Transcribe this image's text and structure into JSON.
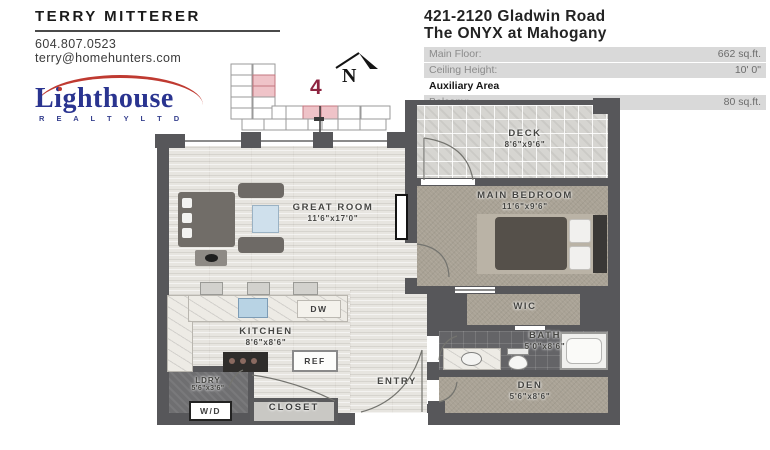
{
  "agent": {
    "name": "TERRY MITTERER",
    "phone": "604.807.0523",
    "email": "terry@homehunters.com"
  },
  "brokerage": {
    "name": "Lighthouse",
    "subtitle": "R E A L T Y   L T D"
  },
  "listing": {
    "address_line": "421-2120 Gladwin Road",
    "building_line": "The ONYX at Mahogany"
  },
  "details": {
    "main_rows": [
      {
        "label": "Main Floor:",
        "value": "662 sq.ft."
      },
      {
        "label": "Ceiling Height:",
        "value": "10' 0\""
      }
    ],
    "aux_header": "Auxiliary Area",
    "aux_rows": [
      {
        "label": "Balcony:",
        "value": "80 sq.ft."
      }
    ]
  },
  "keyplan": {
    "unit_number": "4",
    "highlight_color": "#efc3c8"
  },
  "compass": {
    "label": "N"
  },
  "rooms": {
    "great_room": {
      "name": "GREAT ROOM",
      "dims": "11'6\"x17'0\""
    },
    "deck": {
      "name": "DECK",
      "dims": "8'6\"x9'6\""
    },
    "main_bedroom": {
      "name": "MAIN BEDROOM",
      "dims": "11'6\"x9'6\""
    },
    "wic": {
      "name": "WIC"
    },
    "bath": {
      "name": "BATH",
      "dims": "5'0\"x8'6\""
    },
    "den": {
      "name": "DEN",
      "dims": "5'6\"x8'6\""
    },
    "kitchen": {
      "name": "KITCHEN",
      "dims": "8'6\"x8'6\""
    },
    "ldry": {
      "name": "LDRY",
      "dims": "5'6\"x3'6\""
    },
    "entry": {
      "name": "ENTRY"
    },
    "closet": {
      "name": "CLOSET"
    }
  },
  "appliances": {
    "dishwasher": "DW",
    "fridge": "REF",
    "washer_dryer": "W/D"
  },
  "colors": {
    "wall": "#57575a",
    "accent_red": "#bf3a31",
    "logo_blue": "#2a3490",
    "unit_red": "#8e2440"
  }
}
